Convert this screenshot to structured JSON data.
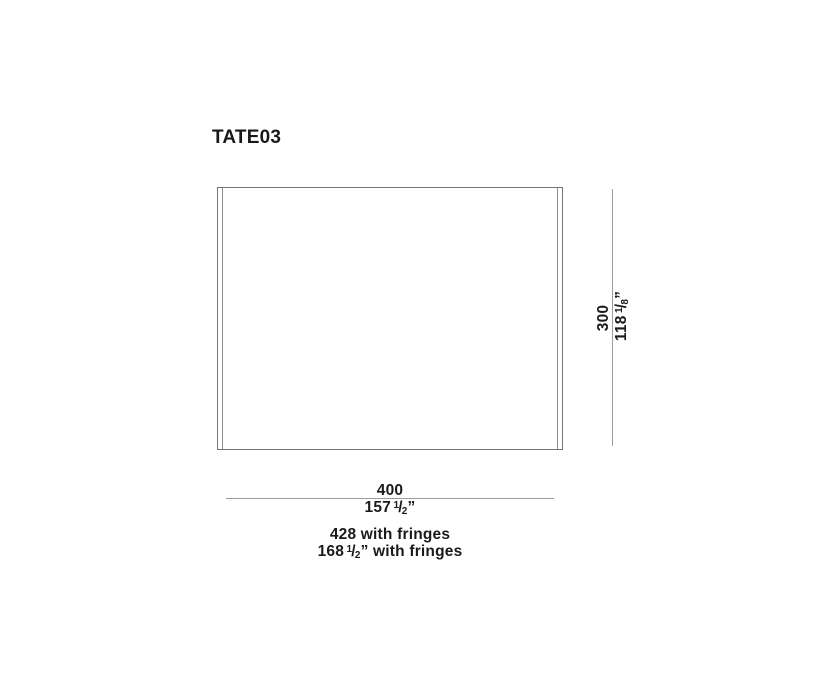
{
  "title": "TATE03",
  "dimensions": {
    "width": {
      "metric": "400",
      "imperial": {
        "main": "157",
        "sup": "1",
        "slash": "/",
        "sub": "2",
        "suffix": "”"
      }
    },
    "height": {
      "metric": "300",
      "imperial": {
        "main": "118",
        "sup": "1",
        "slash": "/",
        "sub": "8",
        "suffix": "”"
      }
    },
    "with_fringes": {
      "metric": "428 with fringes",
      "imperial": {
        "main": "168",
        "sup": "1",
        "slash": "/",
        "sub": "2",
        "suffix": "” with fringes"
      }
    }
  },
  "colors": {
    "text": "#1a1a1a",
    "outline": "#757575",
    "fringe_line": "#8f8f8f",
    "dimension_line": "#9c9c9c",
    "background": "#ffffff"
  }
}
